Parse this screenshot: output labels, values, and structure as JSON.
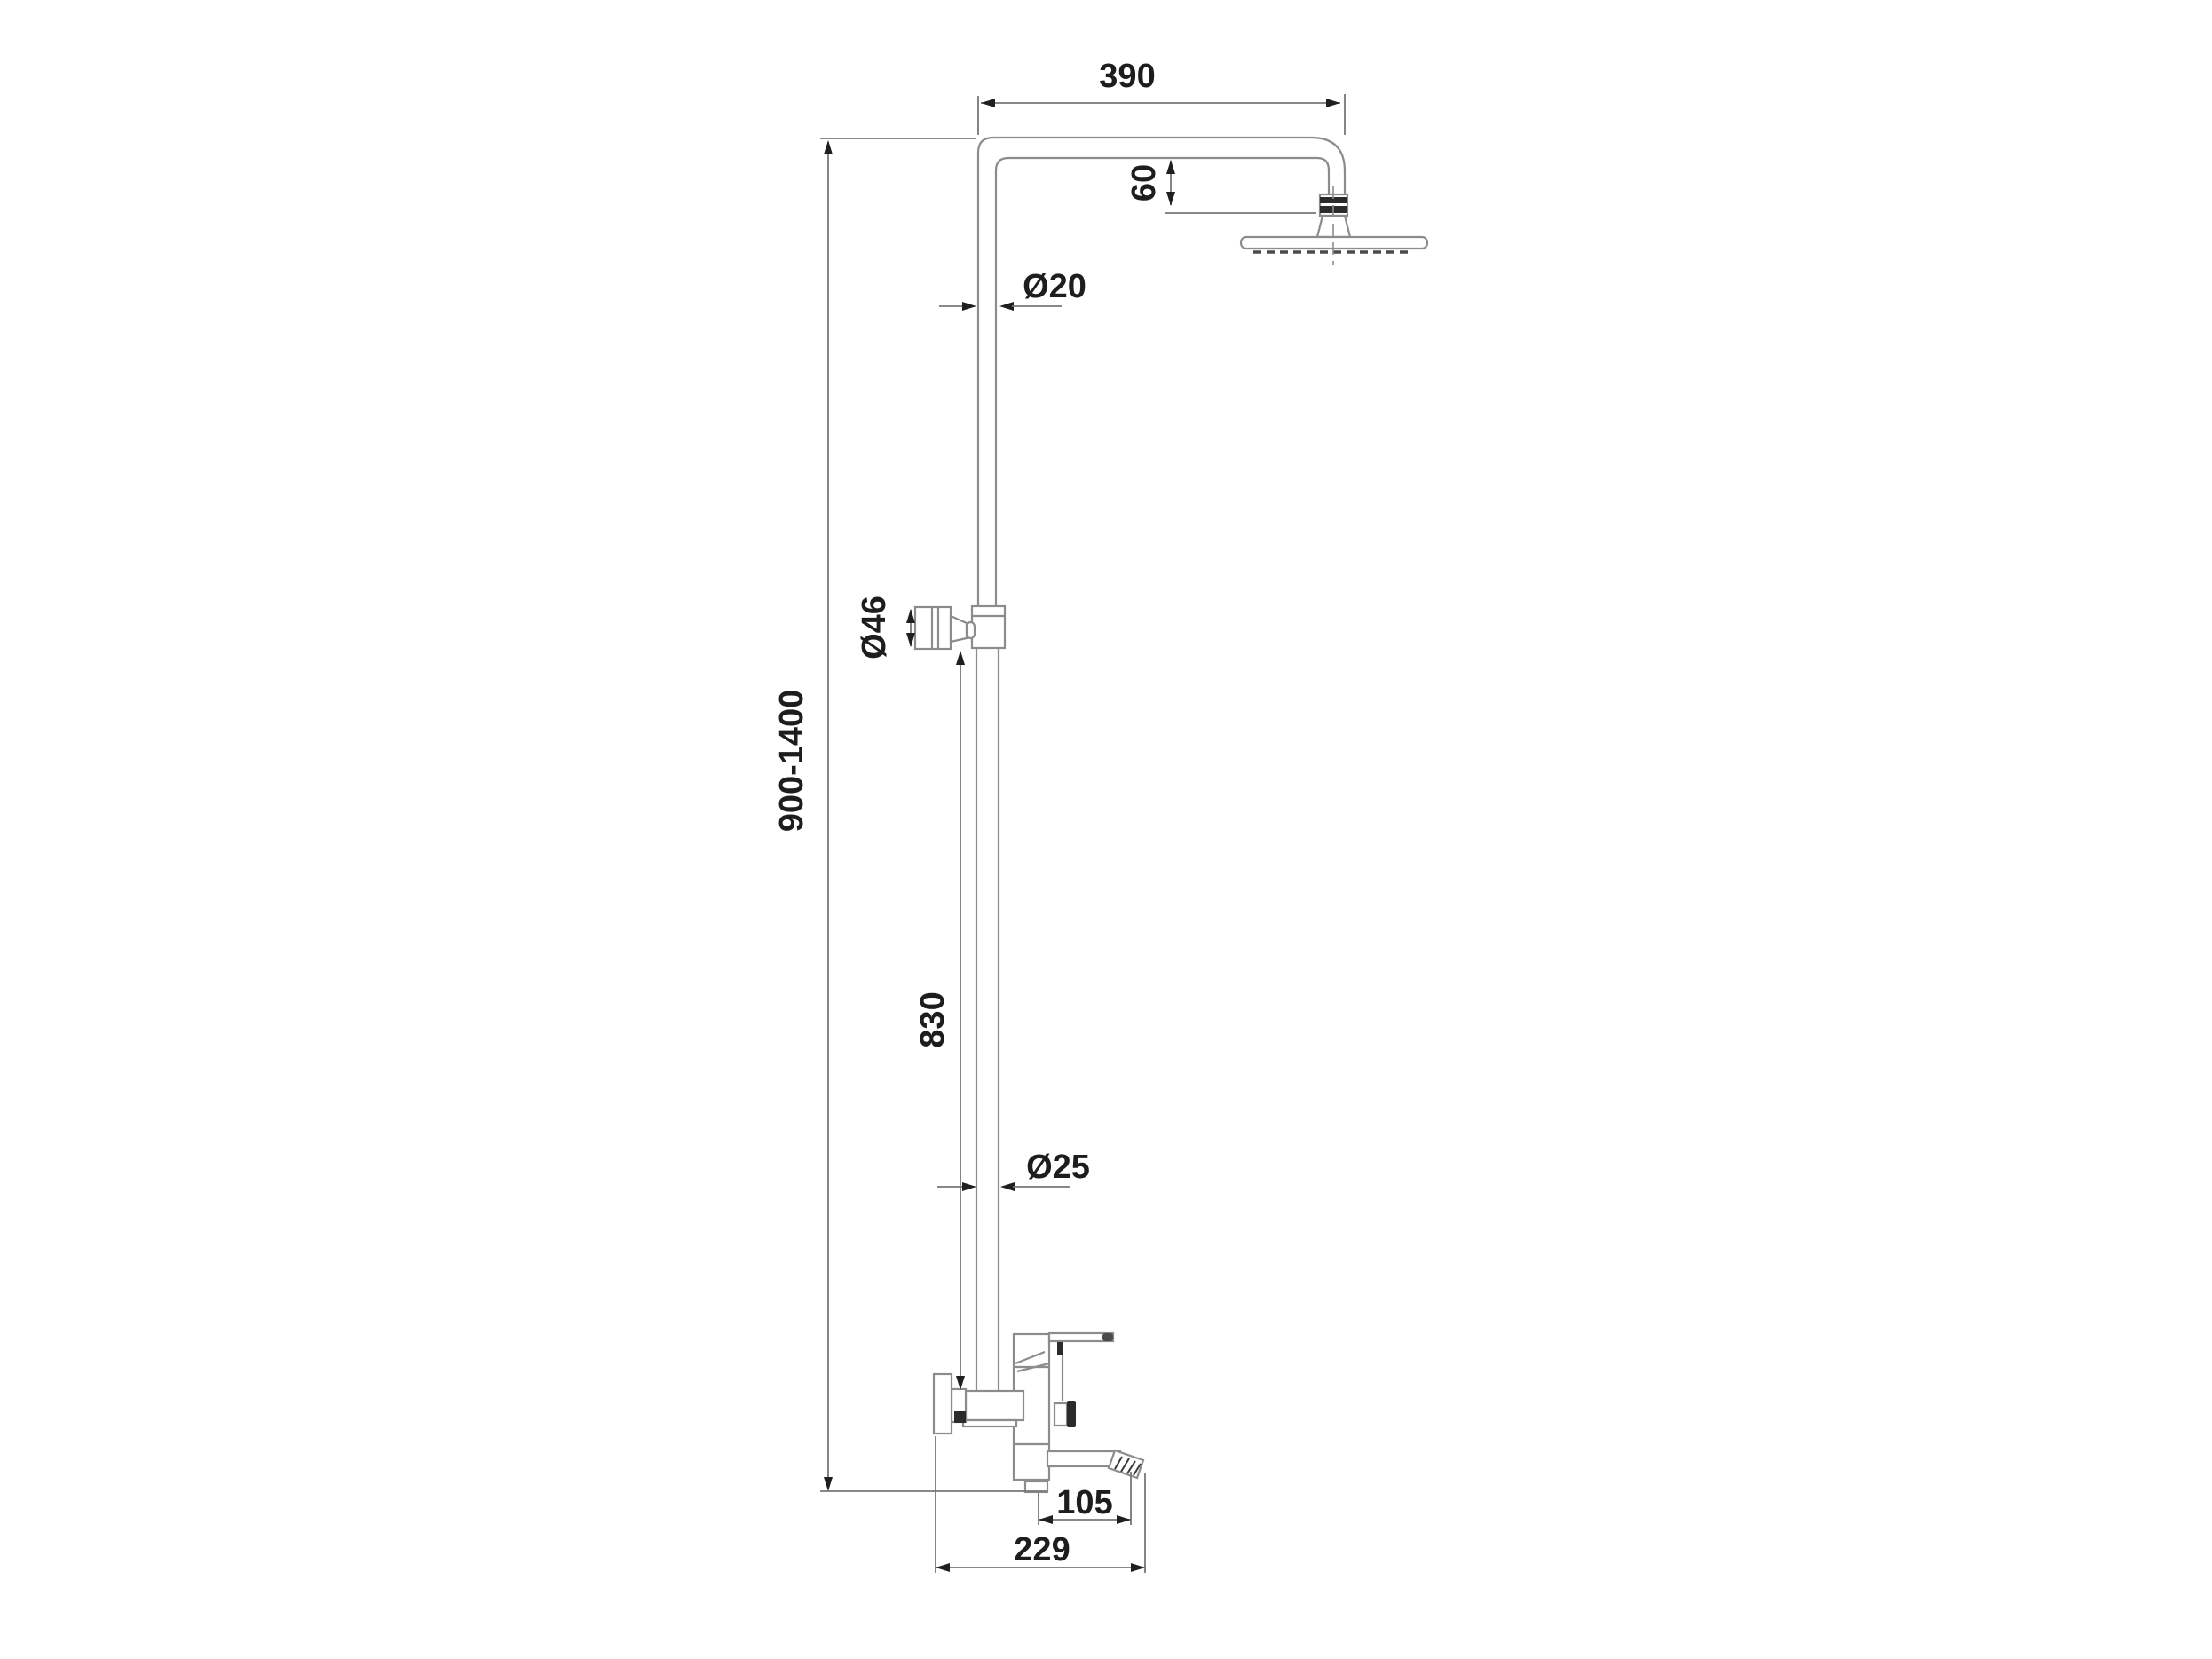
{
  "meta": {
    "background_color": "#ffffff",
    "line_color": "#8c8c8c",
    "dimension_line_color": "#777777",
    "detail_dark_color": "#2b2b2b",
    "text_color": "#1d1d1d"
  },
  "dimensions": {
    "arm_width": "390",
    "head_drop": "60",
    "upper_pipe_diameter": "Ø20",
    "handset_diameter": "Ø46",
    "height_range": "900-1400",
    "lower_pipe_length": "830",
    "lower_pipe_diameter": "Ø25",
    "spout_projection": "105",
    "base_depth": "229"
  }
}
